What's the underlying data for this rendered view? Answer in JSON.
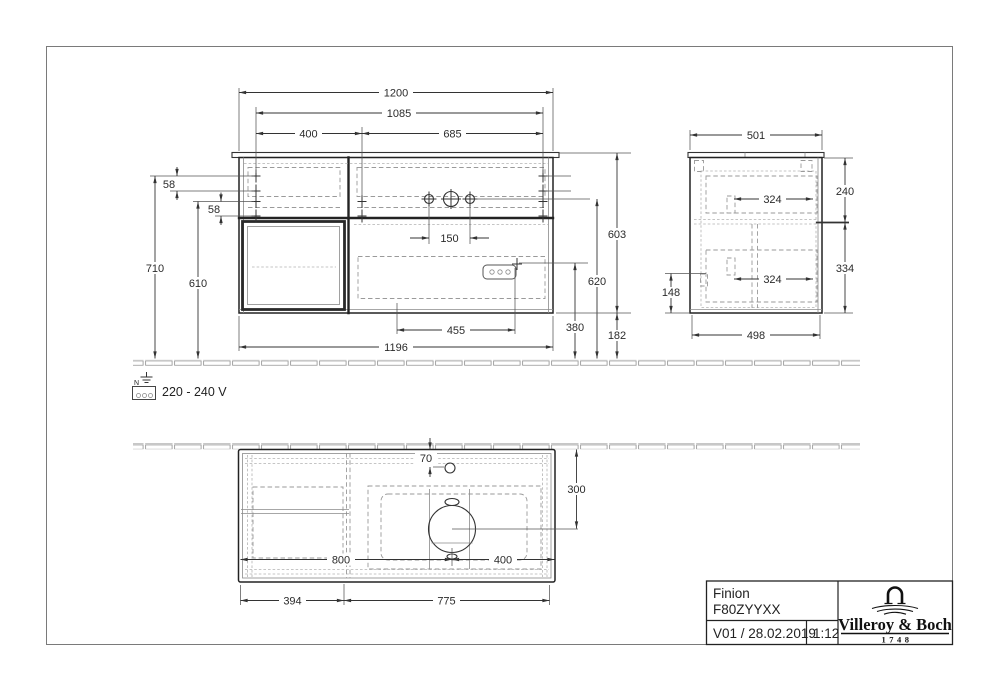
{
  "drawing": {
    "type": "furniture technical drawing",
    "views": [
      "front elevation",
      "side elevation",
      "bottom plan"
    ]
  },
  "front": {
    "d1200": "1200",
    "d1085": "1085",
    "d400": "400",
    "d685": "685",
    "d58a": "58",
    "d58b": "58",
    "d710": "710",
    "d610": "610",
    "d603": "603",
    "d620": "620",
    "d380": "380",
    "d182": "182",
    "d150": "150",
    "d455": "455",
    "d1196": "1196"
  },
  "side": {
    "d501": "501",
    "d324a": "324",
    "d240": "240",
    "d334": "334",
    "d324b": "324",
    "d148": "148",
    "d498": "498"
  },
  "plan": {
    "d70": "70",
    "d300": "300",
    "d800": "800",
    "d400": "400",
    "d394": "394",
    "d775": "775"
  },
  "electrical": {
    "voltage": "220 - 240 V",
    "terminal_label": "N"
  },
  "title_block": {
    "product": "Finion",
    "article": "F80ZYYXX",
    "version": "V01 / 28.02.2019",
    "scale": "1:12",
    "brand": "Villeroy & Boch",
    "since": "1748"
  },
  "colors": {
    "line": "#222222",
    "dashed": "#9a9a9a",
    "dimension": "#333333",
    "background": "#ffffff"
  }
}
